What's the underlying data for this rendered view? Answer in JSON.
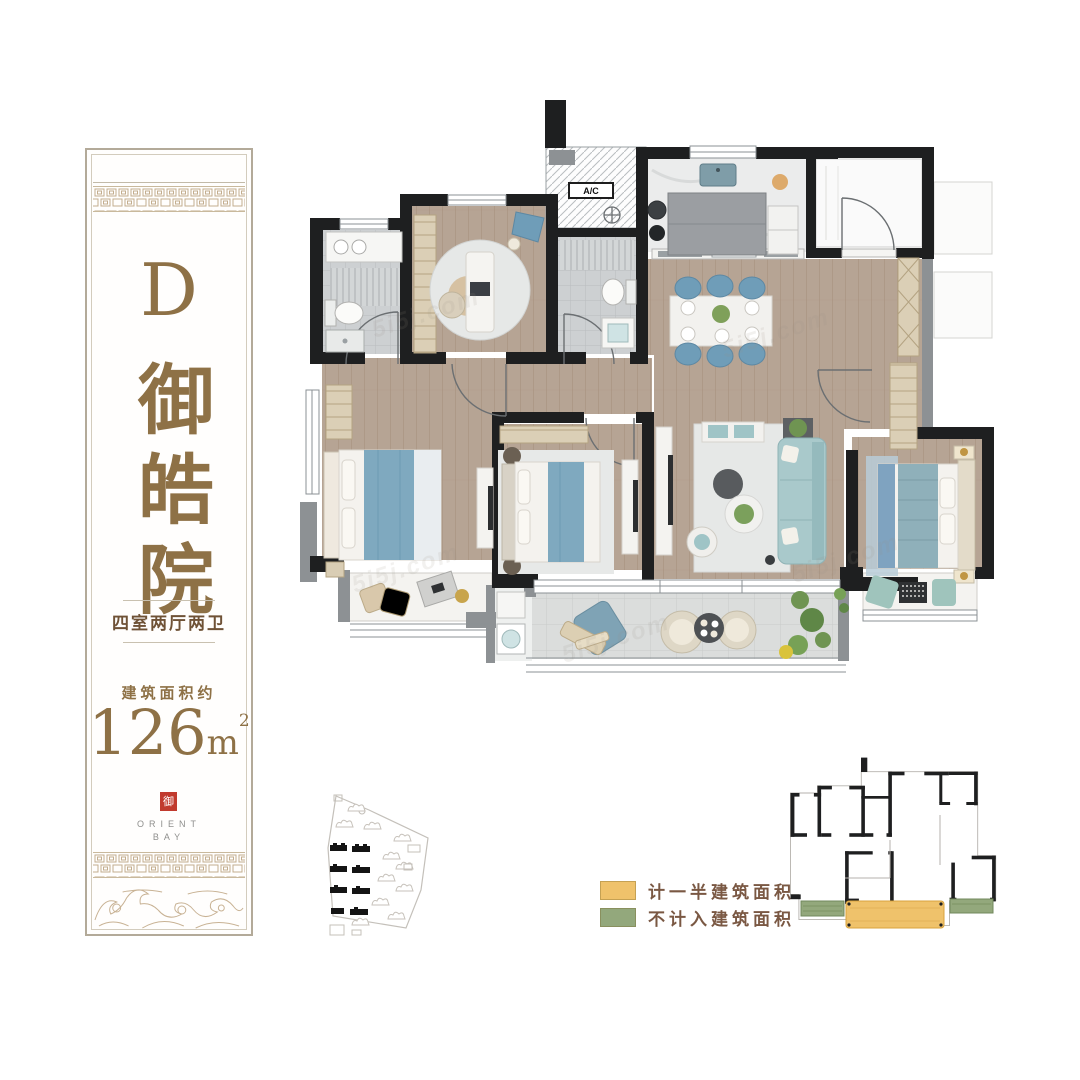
{
  "banner": {
    "unit_letter": "D",
    "project_name": "御皓院",
    "layout_label": "四室两厅两卫",
    "area_caption": "建筑面积约",
    "area_number": "126",
    "area_unit": "m",
    "area_exponent": "2",
    "seal_char": "御",
    "brand_top": "ORIENT",
    "brand_bottom": "BAY",
    "accent_color": "#8e7146"
  },
  "floor_plan": {
    "ac_label": "A/C",
    "watermark_text": "5i5j.com"
  },
  "legend": {
    "items": [
      {
        "label": "计一半建筑面积",
        "color": "#efc26b"
      },
      {
        "label": "不计入建筑面积",
        "color": "#93a87c"
      }
    ]
  }
}
